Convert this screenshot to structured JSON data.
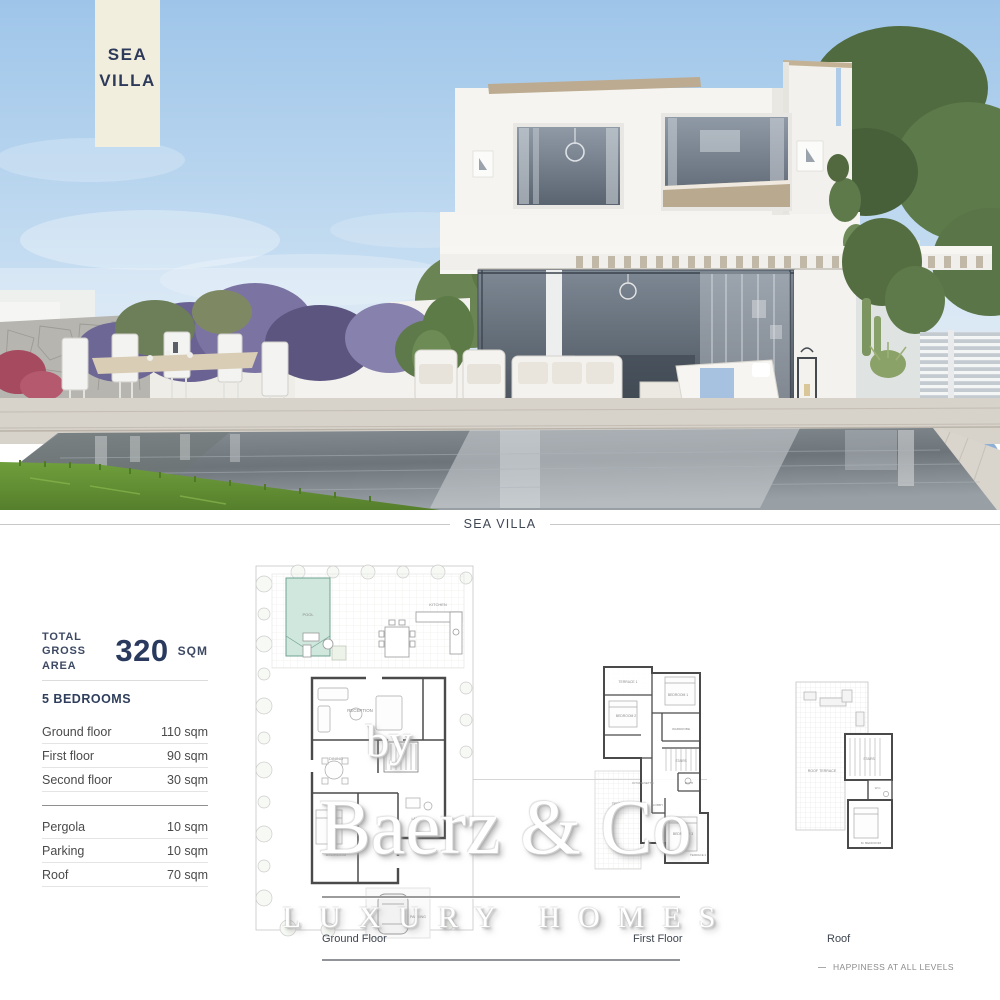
{
  "badge": {
    "line1": "SEA",
    "line2": "VILLA"
  },
  "section_divider": {
    "label": "SEA VILLA"
  },
  "specs": {
    "total": {
      "label_line1": "TOTAL",
      "label_line2": "GROSS AREA",
      "value": "320",
      "unit": "SQM"
    },
    "bedrooms_label": "5 BEDROOMS",
    "floors": [
      {
        "label": "Ground floor",
        "area": "110 sqm"
      },
      {
        "label": "First floor",
        "area": "90 sqm"
      },
      {
        "label": "Second floor",
        "area": "30 sqm"
      }
    ],
    "extras": [
      {
        "label": "Pergola",
        "area": "10 sqm"
      },
      {
        "label": "Parking",
        "area": "10 sqm"
      },
      {
        "label": "Roof",
        "area": "70 sqm"
      }
    ]
  },
  "floorplans": {
    "ground": {
      "caption": "Ground Floor",
      "rooms": {
        "pool": "POOL",
        "kitchen": "KITCHEN",
        "reception": "RECEPTION",
        "dining": "DINING",
        "bedroom": "BEDROOM",
        "laundry": "LAUNDRY",
        "parking": "PARKING"
      }
    },
    "first": {
      "caption": "First Floor",
      "rooms": {
        "terrace1": "TERRACE 1",
        "bedroom2": "BEDROOM 2",
        "bedroom1": "BEDROOM 1",
        "wardrobe": "WARDROBE",
        "stairs": "STAIRS",
        "kitchenette": "KITCHENETTE",
        "bath": "BATH",
        "lobby": "LOBBY",
        "bedroom3": "BEDROOM 3",
        "terrace2": "TERRACE 2",
        "roof_below": "TERR."
      }
    },
    "roof": {
      "caption": "Roof",
      "rooms": {
        "roof_terrace": "ROOF TERRACE",
        "stairs": "STAIRS",
        "wc": "W.C.",
        "bedroom": "M. BEDROOM"
      }
    }
  },
  "watermark": {
    "by": "by",
    "brand": "Baerz & Co",
    "tagline": "LUXURY HOMES"
  },
  "footer": {
    "motto": "HAPPINESS AT ALL LEVELS"
  },
  "colors": {
    "navy": "#2a3a5e",
    "cream": "#f2eedd",
    "sky": "#9ec5e9",
    "pool_plan_teal": "#cfe7dd",
    "text_gray": "#4a4a4a",
    "line_gray": "#9b9b9b"
  }
}
